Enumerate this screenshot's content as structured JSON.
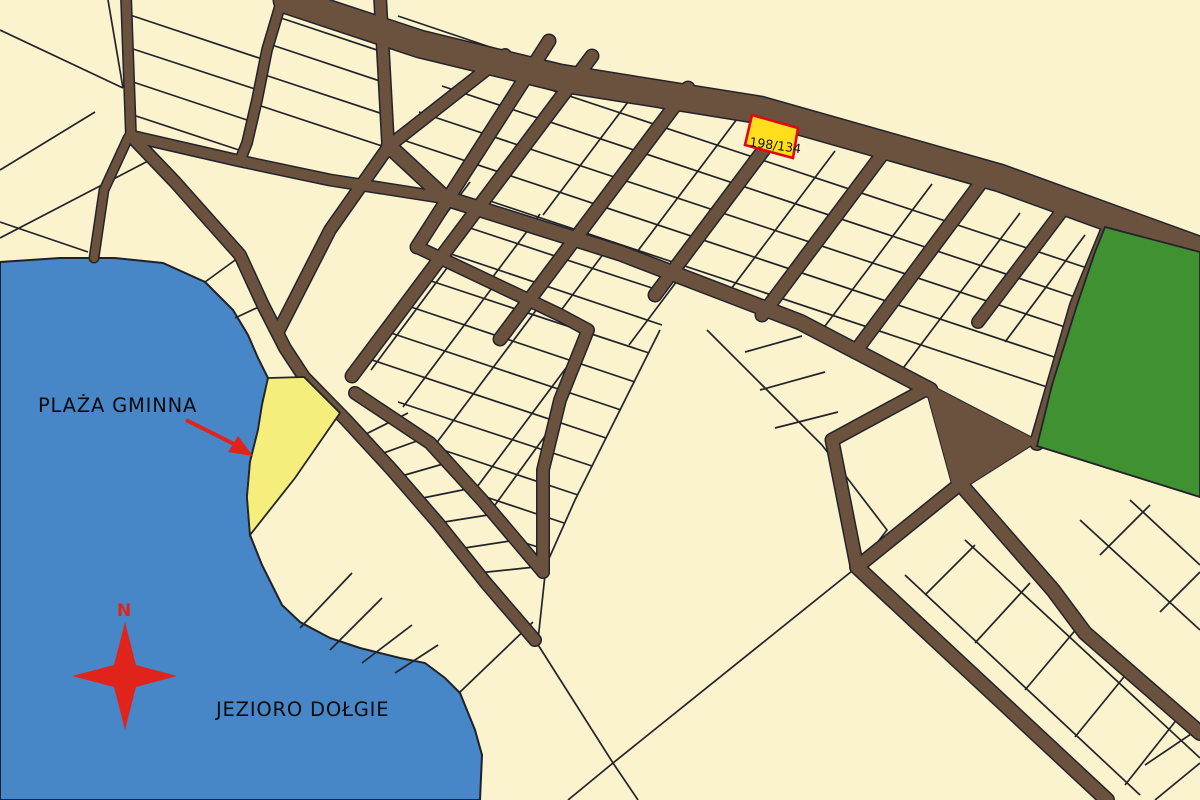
{
  "map": {
    "type": "cadastral-parcel-map",
    "highlighted_parcel": {
      "id": "198/134"
    },
    "labels": {
      "beach": "PLAŻA GMINNA",
      "lake": "JEZIORO DOŁGIE",
      "compass_north": "N"
    },
    "colors": {
      "parcel_fill": "#FAF3CD",
      "road": "#6B523E",
      "boundary": "#23232C",
      "lake": "#4787C8",
      "forest": "#3F9132",
      "beach": "#F5EE7C",
      "highlight_fill": "#FFDE1E",
      "highlight_stroke": "#E30613",
      "accent_red": "#E0241B",
      "label_text": "#0B0B0B"
    }
  }
}
